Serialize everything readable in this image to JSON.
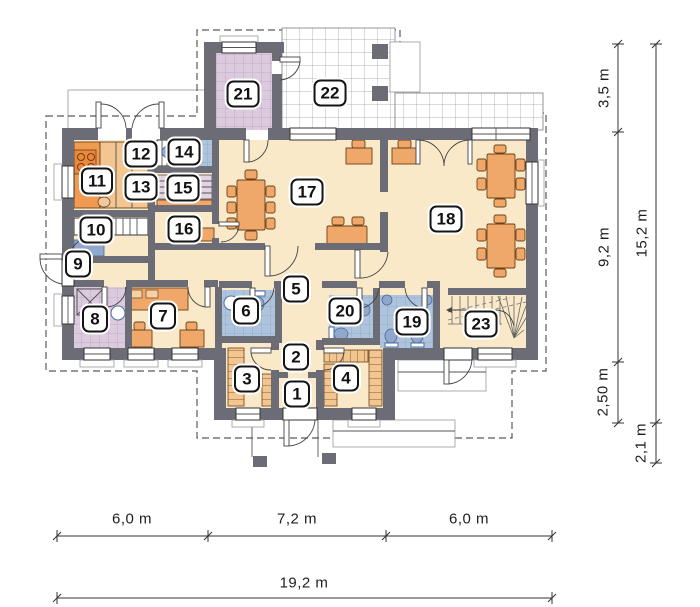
{
  "title": "House ground-floor plan",
  "colors": {
    "wall": "#6c6c76",
    "floor": "#fae9c8",
    "tile_blue": "#aec3dc",
    "tile_blue_line": "#8da7c6",
    "tile_lavender": "#dccade",
    "tile_lavender_line": "#bda4bf",
    "furniture": "#efa76a",
    "furniture_accent": "#f09a52",
    "fixture": "#8fa8cc",
    "terrace_line": "#9a9aa2",
    "dashed": "#5a5a5a",
    "dimension": "#1e1e1e",
    "badge_border": "#141414"
  },
  "rooms": [
    {
      "number": "1",
      "x": 297,
      "y": 394
    },
    {
      "number": "2",
      "x": 296,
      "y": 357
    },
    {
      "number": "3",
      "x": 247,
      "y": 379
    },
    {
      "number": "4",
      "x": 346,
      "y": 378
    },
    {
      "number": "5",
      "x": 296,
      "y": 289
    },
    {
      "number": "6",
      "x": 246,
      "y": 311
    },
    {
      "number": "7",
      "x": 163,
      "y": 316
    },
    {
      "number": "8",
      "x": 95,
      "y": 319
    },
    {
      "number": "9",
      "x": 78,
      "y": 264
    },
    {
      "number": "10",
      "x": 96,
      "y": 230
    },
    {
      "number": "11",
      "x": 97,
      "y": 181
    },
    {
      "number": "12",
      "x": 141,
      "y": 154
    },
    {
      "number": "13",
      "x": 141,
      "y": 187
    },
    {
      "number": "14",
      "x": 184,
      "y": 152
    },
    {
      "number": "15",
      "x": 183,
      "y": 188
    },
    {
      "number": "16",
      "x": 184,
      "y": 229
    },
    {
      "number": "17",
      "x": 307,
      "y": 192
    },
    {
      "number": "18",
      "x": 446,
      "y": 219
    },
    {
      "number": "19",
      "x": 412,
      "y": 322
    },
    {
      "number": "20",
      "x": 345,
      "y": 311
    },
    {
      "number": "21",
      "x": 243,
      "y": 94
    },
    {
      "number": "22",
      "x": 330,
      "y": 93
    },
    {
      "number": "23",
      "x": 481,
      "y": 324
    }
  ],
  "dimensions": {
    "bottom": {
      "segments": [
        {
          "label": "6,0 m"
        },
        {
          "label": "7,2 m"
        },
        {
          "label": "6,0 m"
        }
      ],
      "total": {
        "label": "19,2 m"
      }
    },
    "right": {
      "segments": [
        {
          "label": "3,5 m"
        },
        {
          "label": "9,2 m"
        },
        {
          "label": "2,50 m"
        }
      ],
      "total": {
        "label": "15,2 m"
      },
      "extra": {
        "label": "2,1 m"
      }
    }
  }
}
